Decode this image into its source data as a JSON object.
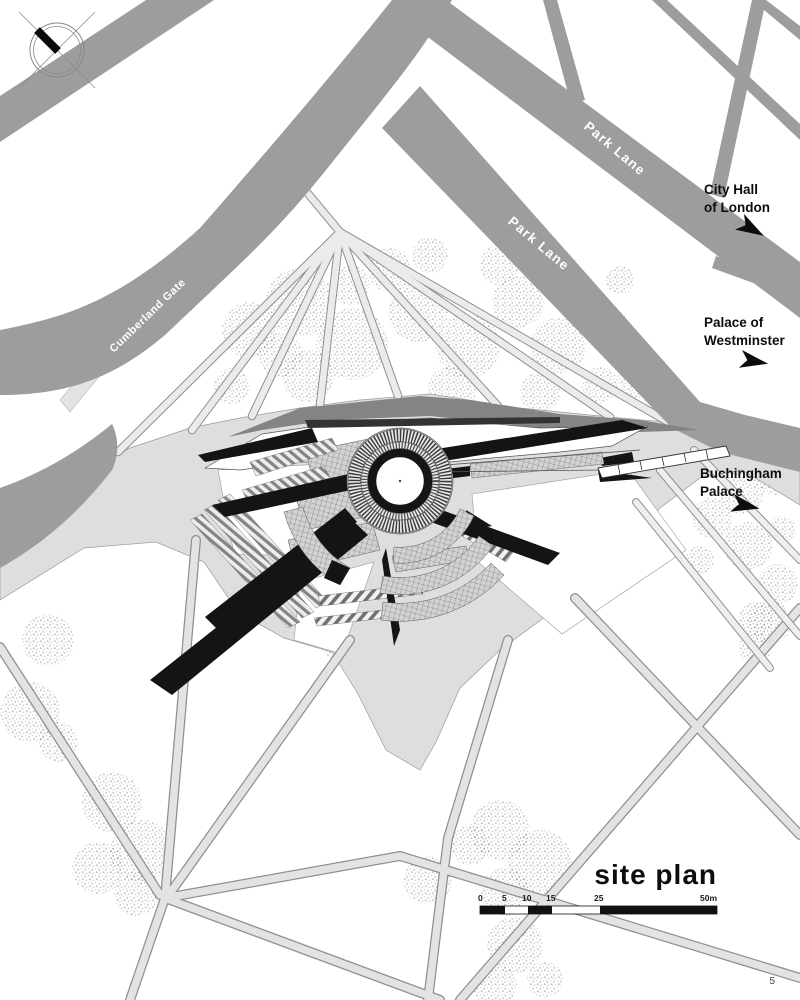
{
  "page": {
    "number": "5"
  },
  "titleblock": {
    "title": "site plan"
  },
  "scalebar": {
    "ticks": [
      "0",
      "5",
      "10",
      "15",
      "25",
      "50m"
    ]
  },
  "roads": {
    "park_lane_upper": "Park Lane",
    "park_lane_lower": "Park Lane",
    "cumberland_gate": "Cumberland Gate",
    "n_carriage_dr": "N Carriage Dr"
  },
  "landmarks": {
    "city_hall": {
      "line1": "City Hall",
      "line2": "of London"
    },
    "westminster": {
      "line1": "Palace of",
      "line2": "Westminster"
    },
    "buckingham": {
      "line1": "Buchingham",
      "line2": "Palace"
    }
  },
  "colors": {
    "road": "#9d9d9d",
    "plaza": "#dedede",
    "path": "#e3e3e3",
    "shadow": "#848484",
    "ink": "#141414"
  }
}
